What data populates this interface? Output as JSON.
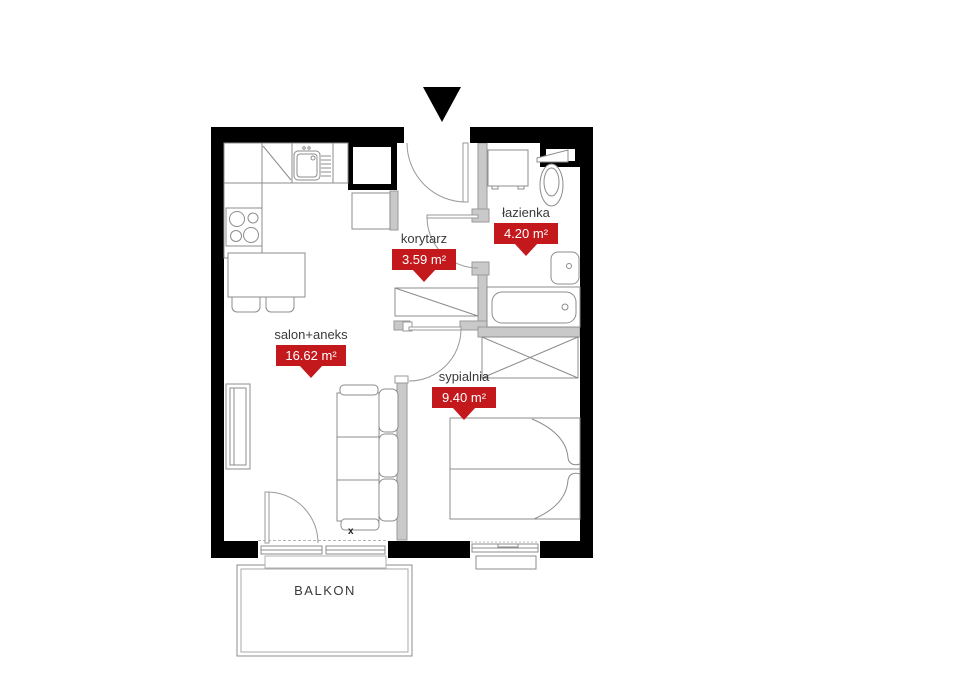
{
  "plan": {
    "rooms": [
      {
        "name": "salon+aneks",
        "area": "16.62 m²"
      },
      {
        "name": "korytarz",
        "area": "3.59 m²"
      },
      {
        "name": "łazienka",
        "area": "4.20 m²"
      },
      {
        "name": "sypialnia",
        "area": "9.40 m²"
      }
    ],
    "balcony_label": "BALKON",
    "window_marker": "x",
    "colors": {
      "badge_red": "#c3191d",
      "wall_black": "#000000",
      "partition_gray": "#c9c9c9",
      "label_text": "#3a3a3a",
      "badge_text": "#ffffff"
    }
  }
}
